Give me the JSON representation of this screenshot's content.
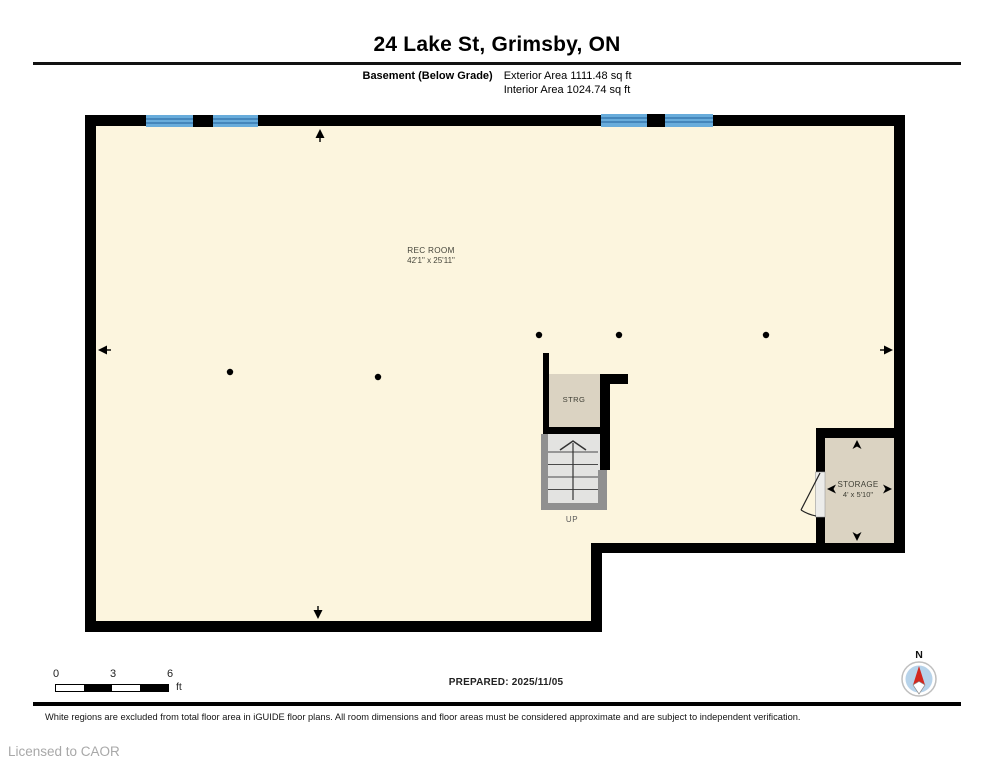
{
  "header": {
    "title": "24 Lake St, Grimsby, ON",
    "floor_label": "Basement (Below Grade)",
    "exterior_area": "Exterior Area 1111.48 sq ft",
    "interior_area": "Interior Area 1024.74 sq ft"
  },
  "plan": {
    "rec_room": {
      "name": "REC ROOM",
      "dims": "42'1\" x 25'11\""
    },
    "strg": {
      "name": "STRG"
    },
    "storage": {
      "name": "STORAGE",
      "dims": "4' x 5'10\""
    },
    "stairs": {
      "label": "UP"
    }
  },
  "scale_bar": {
    "start": "0",
    "mid": "3",
    "end": "6",
    "unit": "ft"
  },
  "compass": {
    "north": "N"
  },
  "footer": {
    "prepared": "PREPARED: 2025/11/05",
    "disclaimer": "White regions are excluded from total floor area in iGUIDE floor plans. All room dimensions and floor areas must be considered approximate and are subject to independent verification.",
    "license": "Licensed to CAOR"
  },
  "colors": {
    "floor": "#FCF5DE",
    "closet": "#DBD3C2",
    "wall": "#000000",
    "window": "#68ACDB",
    "window_line": "#2F6FA8",
    "stair_frame": "#909090",
    "stair_steps": "#E3E3E1",
    "compass_disc": "#B7D3EA",
    "compass_needle": "#D3281E"
  }
}
